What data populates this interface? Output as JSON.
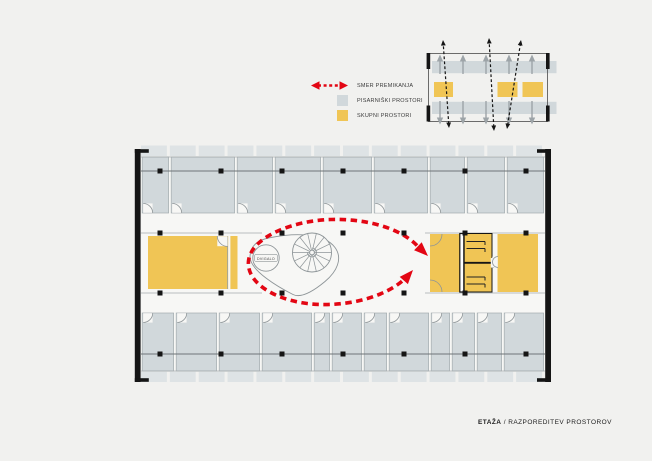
{
  "colors": {
    "page_bg": "#F1F1EF",
    "plan_bg": "#F7F7F5",
    "office": "#D1D8DB",
    "office_light": "#DEE3E5",
    "common": "#F0C555",
    "movement": "#E30613",
    "wall": "#151515",
    "line": "#A3ABAE",
    "line_dark": "#6E7578",
    "stair_line": "#8E9598",
    "mini_arrow": "#9DA4A8"
  },
  "legend": {
    "items": [
      {
        "type": "arrow",
        "icon": "movement-direction",
        "label": "SMER PREMIKANJA"
      },
      {
        "type": "swatch",
        "icon": "office-spaces-swatch",
        "color": "office",
        "label": "PISARNIŠKI PROSTORI"
      },
      {
        "type": "swatch",
        "icon": "common-spaces-swatch",
        "color": "common",
        "label": "SKUPNI PROSTORI"
      }
    ]
  },
  "caption": {
    "bold": "ETAŽA",
    "rest": " / RAZPOREDITEV PROSTOROV"
  },
  "main_plan": {
    "elevator_label": "DVIGALO",
    "top_rooms": [
      29,
      66,
      38,
      48,
      51,
      56,
      37,
      40,
      39
    ],
    "bottom_rooms": [
      34,
      43,
      43,
      52,
      18,
      32,
      25,
      42,
      21,
      25,
      27,
      42
    ],
    "balcony_segments": 14,
    "columns_x": [
      160,
      221,
      282,
      343,
      404,
      465,
      526
    ],
    "column_rows_y": [
      171,
      233,
      293,
      354
    ]
  },
  "mini_plan": {
    "up_arrows_x": [
      440,
      463,
      486,
      509,
      532
    ],
    "dashed_arrows": [
      [
        449,
        128,
        443,
        40
      ],
      [
        494,
        131,
        489,
        38
      ],
      [
        507,
        129,
        521,
        40
      ]
    ]
  }
}
